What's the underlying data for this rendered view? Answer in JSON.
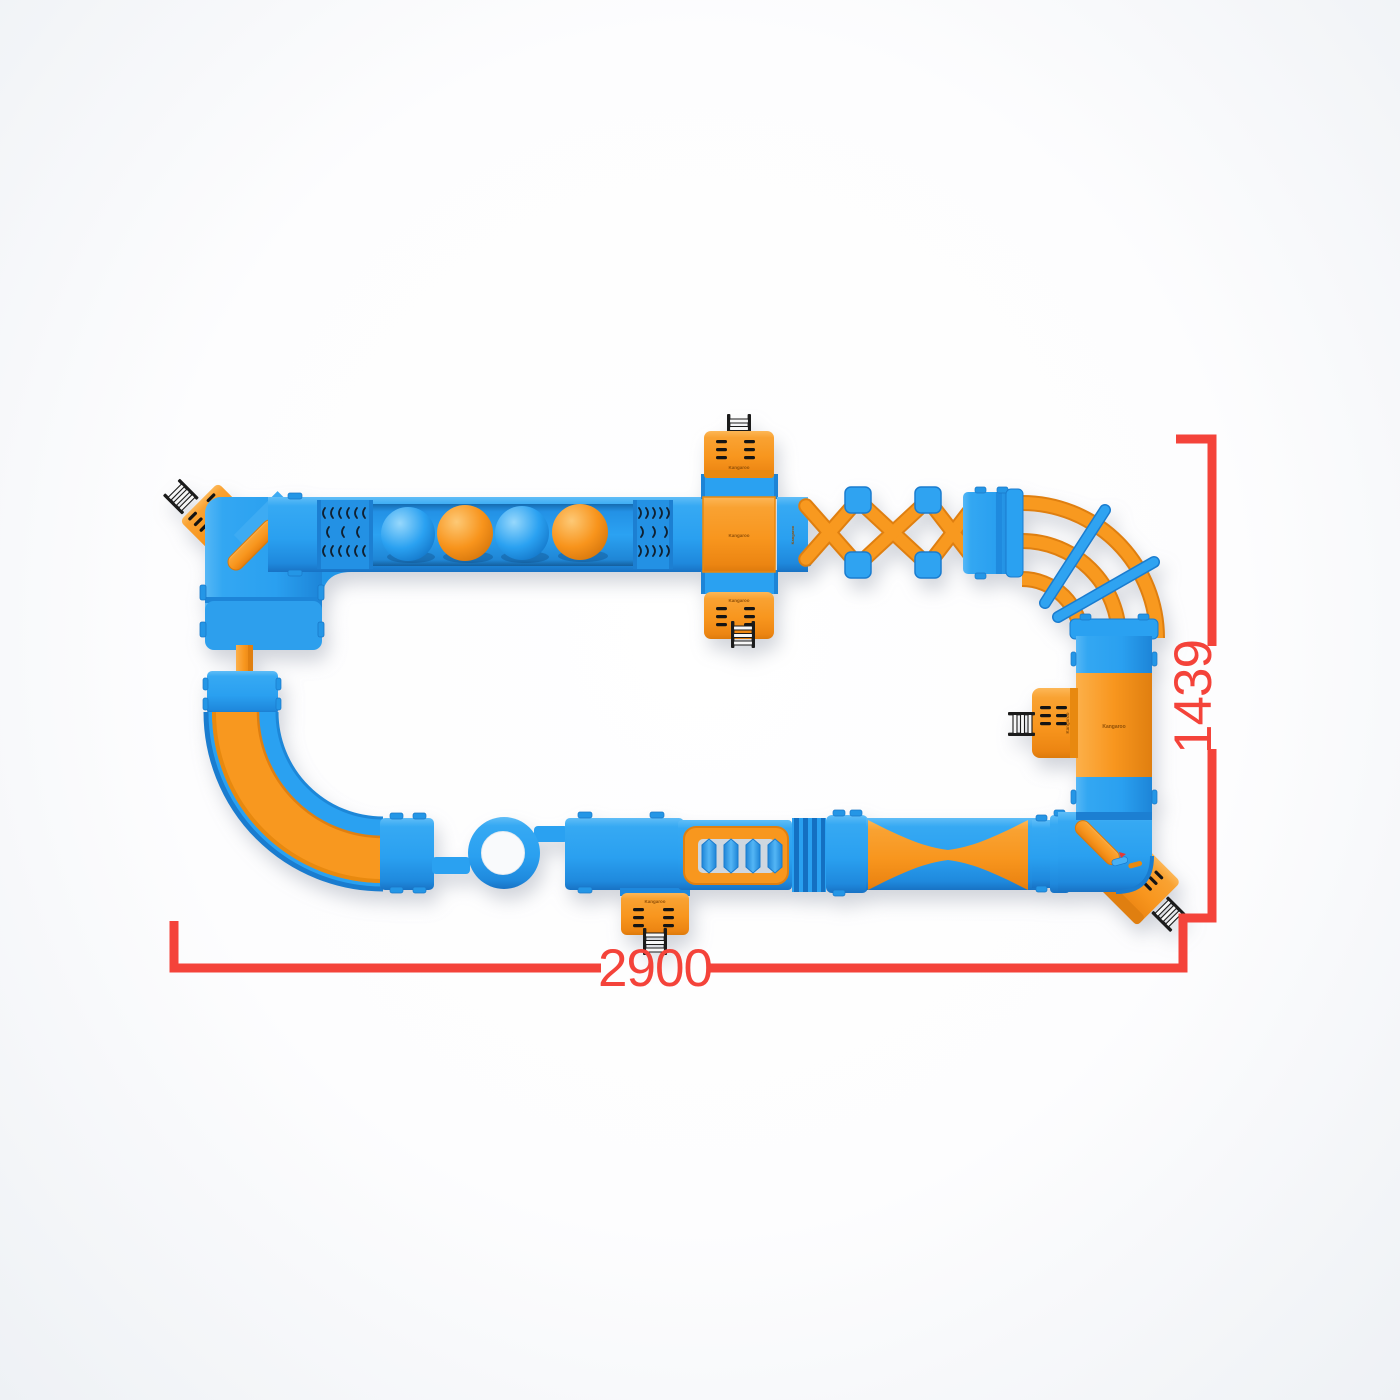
{
  "page": {
    "description": "Top view render of a modular inflatable water obstacle course with red dimension annotations",
    "background_color": "#ffffff"
  },
  "dimensions": {
    "width_label": "2900",
    "height_label": "1439",
    "line_color": "#f4433a"
  },
  "brand": {
    "logo_text": "Kangaroo"
  },
  "palette": {
    "blue": "#2aa1f1",
    "blue_light": "#5cbbf7",
    "blue_dark": "#1a7ccf",
    "orange": "#f8991f",
    "orange_light": "#fcb454",
    "orange_dark": "#e07f10",
    "ladder_black": "#1b1b1b",
    "dimension_red": "#f4433a"
  },
  "ball_run": {
    "ball_colors": [
      "blue",
      "orange",
      "blue",
      "orange"
    ]
  },
  "modules": [
    {
      "id": "entry-platform-top-left",
      "type": "diagonal-platform-with-ladder"
    },
    {
      "id": "corner-elbow-top-left",
      "type": "corner-tube"
    },
    {
      "id": "vent-beam-left",
      "type": "straight-beam-with-vents"
    },
    {
      "id": "ball-run",
      "type": "floating-balls-lane"
    },
    {
      "id": "vent-beam-right",
      "type": "straight-beam-with-vents"
    },
    {
      "id": "cross-platform",
      "type": "four-way-platform-with-ladders"
    },
    {
      "id": "x-lattice-bridge",
      "type": "crossed-beam-bridge"
    },
    {
      "id": "curved-tube-bridge",
      "type": "triple-arc-corner"
    },
    {
      "id": "tower-section-right",
      "type": "straight-section"
    },
    {
      "id": "side-platform-right",
      "type": "platform-with-ladder"
    },
    {
      "id": "corner-elbow-bottom-right",
      "type": "corner-tube"
    },
    {
      "id": "entry-platform-bottom-right",
      "type": "diagonal-platform-with-ladder"
    },
    {
      "id": "hourglass-runway",
      "type": "bowtie-section"
    },
    {
      "id": "ribbed-connector",
      "type": "striped-connector"
    },
    {
      "id": "roller-bridge",
      "type": "roller-obstacle"
    },
    {
      "id": "entry-platform-bottom-center",
      "type": "platform-with-ladder"
    },
    {
      "id": "ring-section",
      "type": "donut-float"
    },
    {
      "id": "quarter-turn-slide-bottom-left",
      "type": "curved-slide"
    },
    {
      "id": "tube-connector-left",
      "type": "narrow-tube"
    }
  ]
}
